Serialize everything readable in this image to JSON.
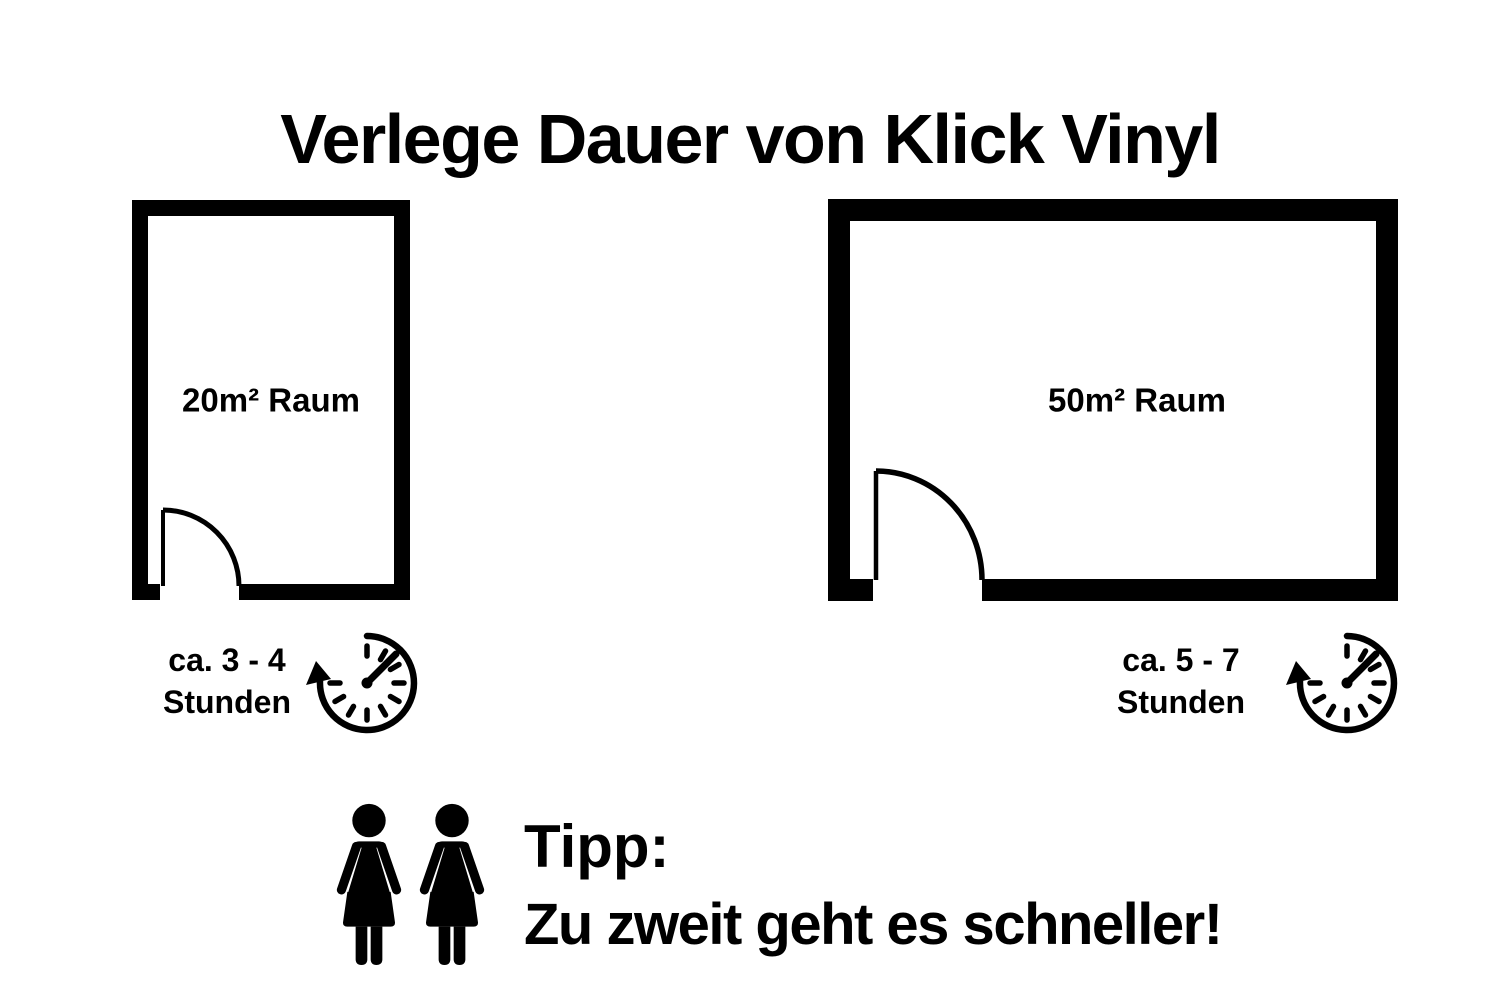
{
  "title": "Verlege Dauer von Klick Vinyl",
  "rooms": [
    {
      "label": "20m² Raum",
      "duration_line1": "ca. 3 - 4",
      "duration_line2": "Stunden"
    },
    {
      "label": "50m² Raum",
      "duration_line1": "ca. 5 - 7",
      "duration_line2": "Stunden"
    }
  ],
  "tip": {
    "heading": "Tipp:",
    "text": "Zu zweit geht es schneller!"
  },
  "icons": {
    "timer": "stopwatch-timer-icon",
    "people": "two-women-icon"
  },
  "colors": {
    "foreground": "#000000",
    "background": "#ffffff"
  }
}
